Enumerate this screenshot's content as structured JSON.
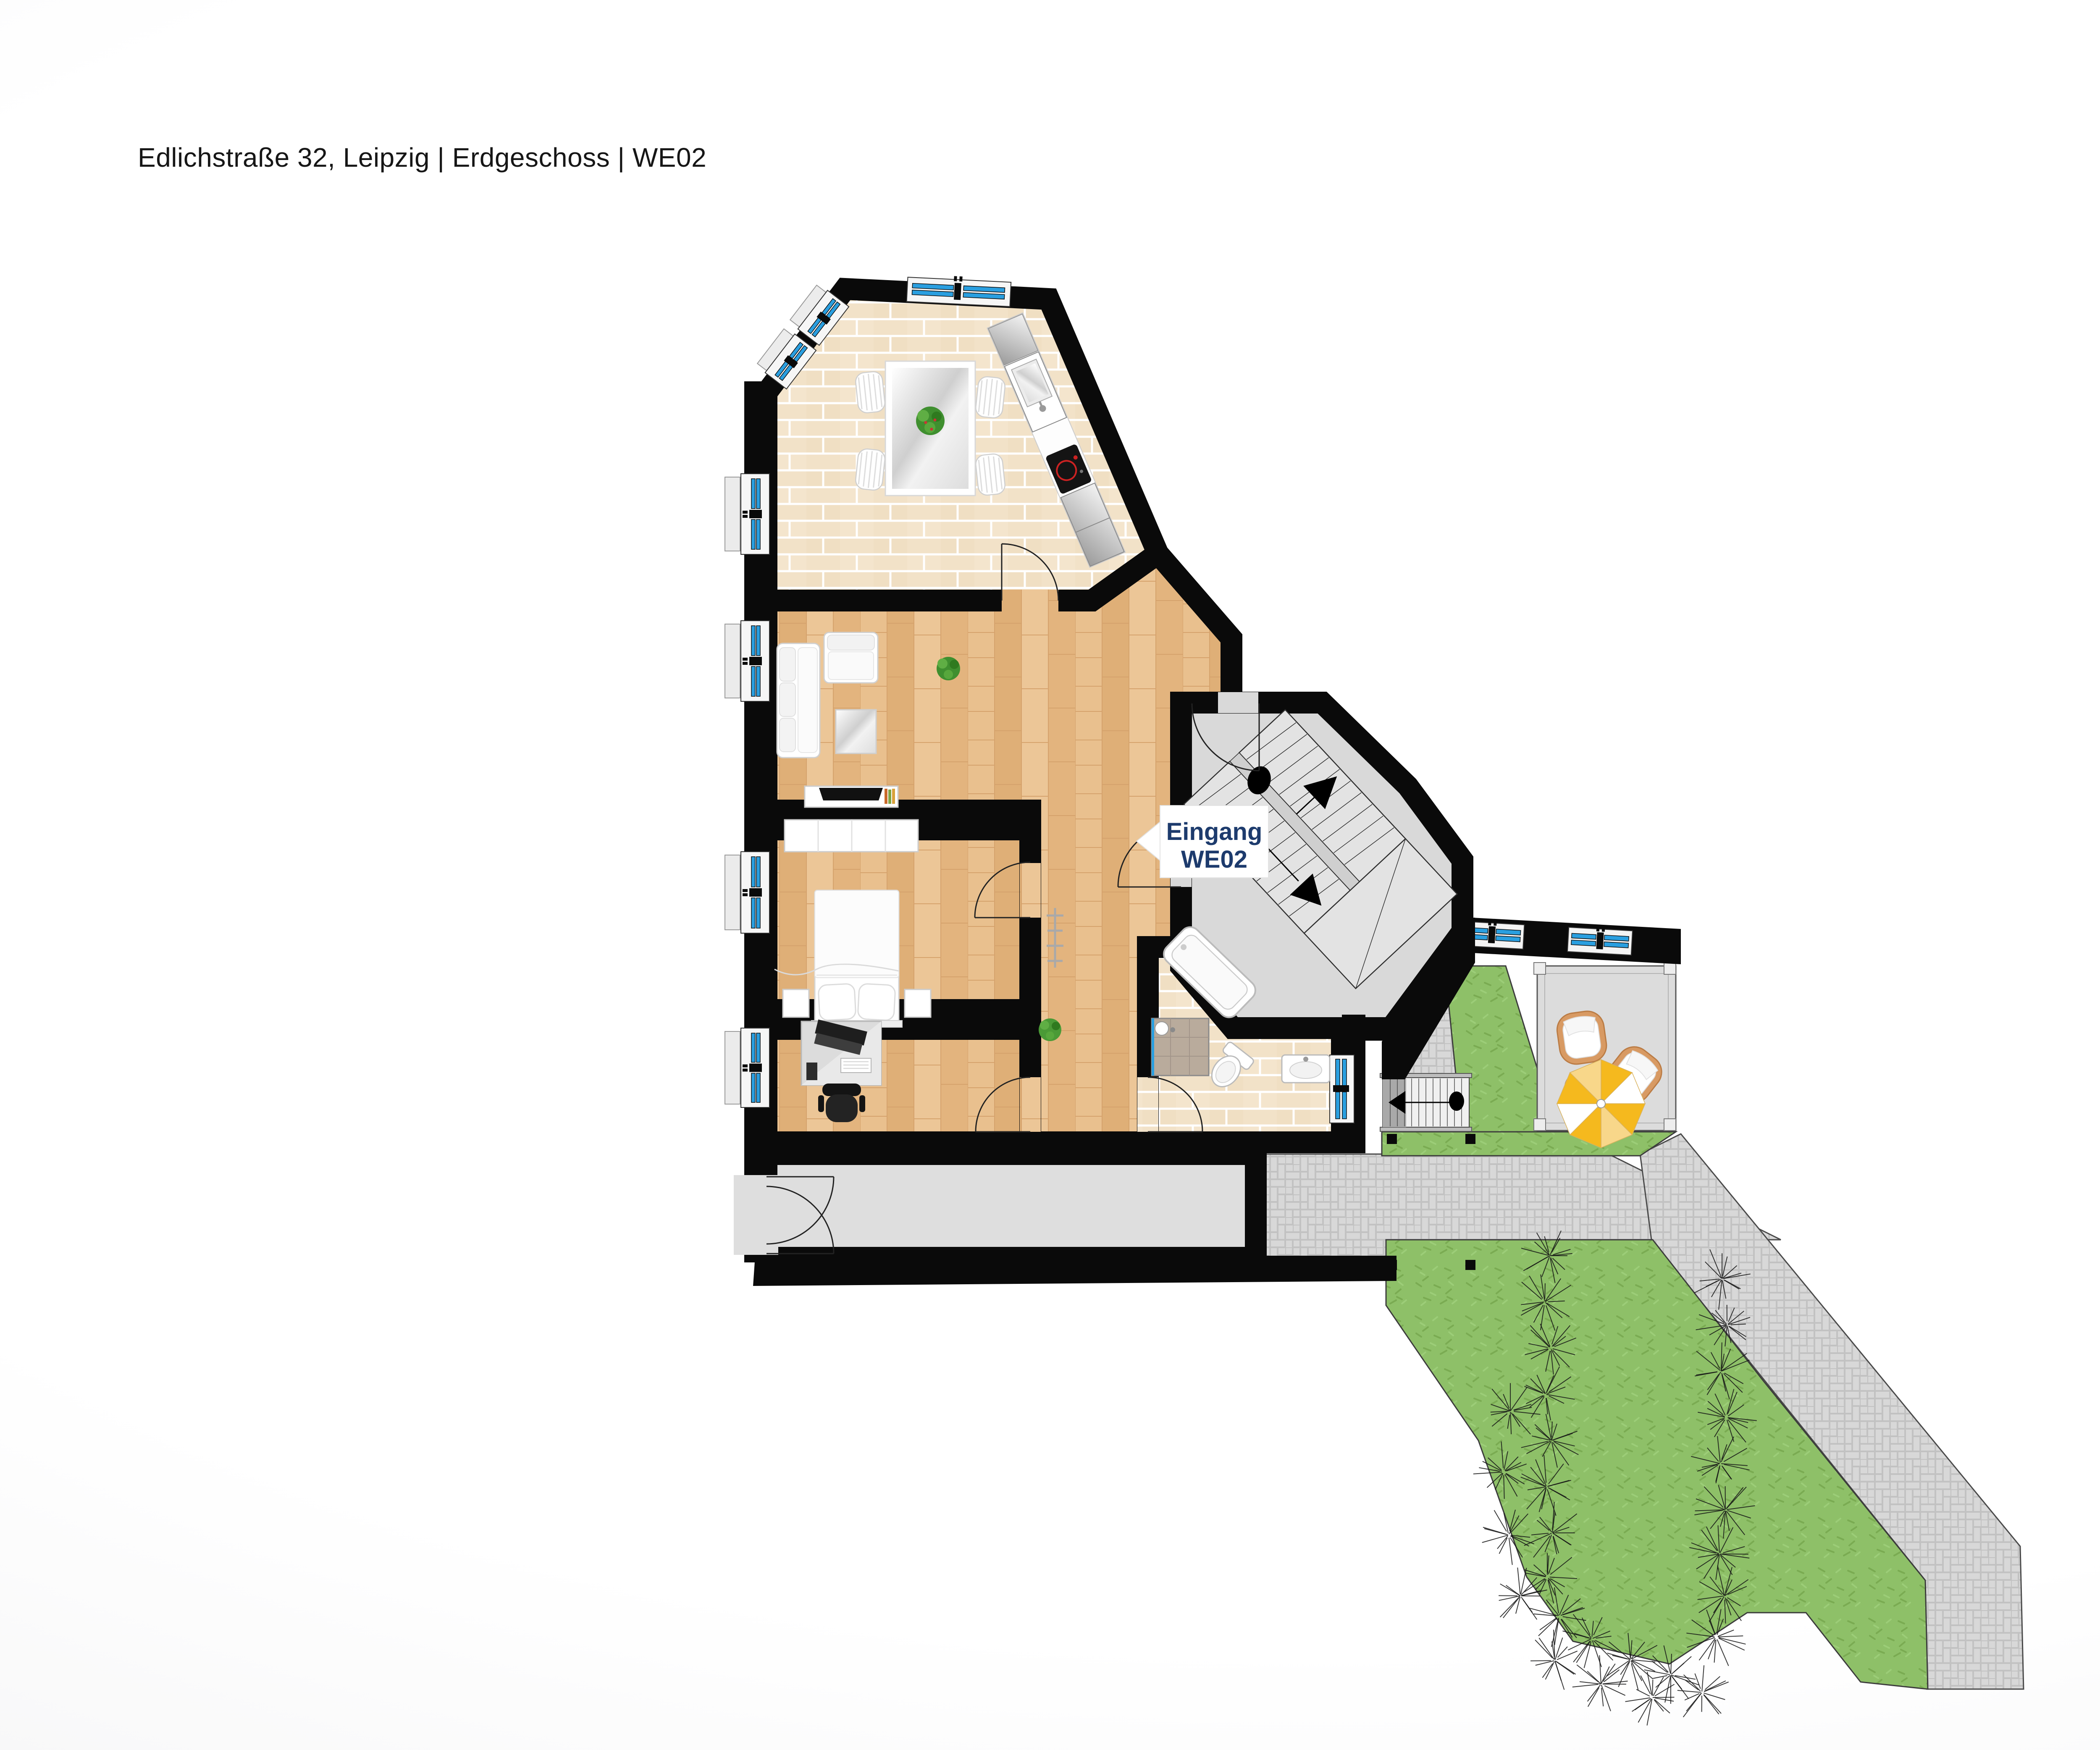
{
  "header": {
    "title": "Edlichstraße 32, Leipzig | Erdgeschoss | WE02"
  },
  "logo": {
    "brand": "ISIHOME",
    "registered_mark": "®",
    "tagline": "Immobilien. Bau. Kompetenz.",
    "stripe_colors": [
      "#c6d41f",
      "#95b43b",
      "#27a5de",
      "#2d4a9a"
    ],
    "navy": "#1d3b6d"
  },
  "floorplan": {
    "entrance_label": {
      "line1": "Eingang",
      "line2": "WE02"
    }
  },
  "footer": {
    "website": "isihome.de",
    "blue": "#1e9ed9"
  },
  "palette": {
    "wall_black": "#0a0a0a",
    "wood_floor": "#e6bb86",
    "tile_beige": "#f2e2c8",
    "lawn_green": "#8ec068",
    "paver_gray": "#d8d8d8",
    "floor_gray": "#d9d9d9",
    "window_blue": "#2a9fe0",
    "accent_navy": "#1d3b6d",
    "accent_blue": "#1e9ed9"
  }
}
